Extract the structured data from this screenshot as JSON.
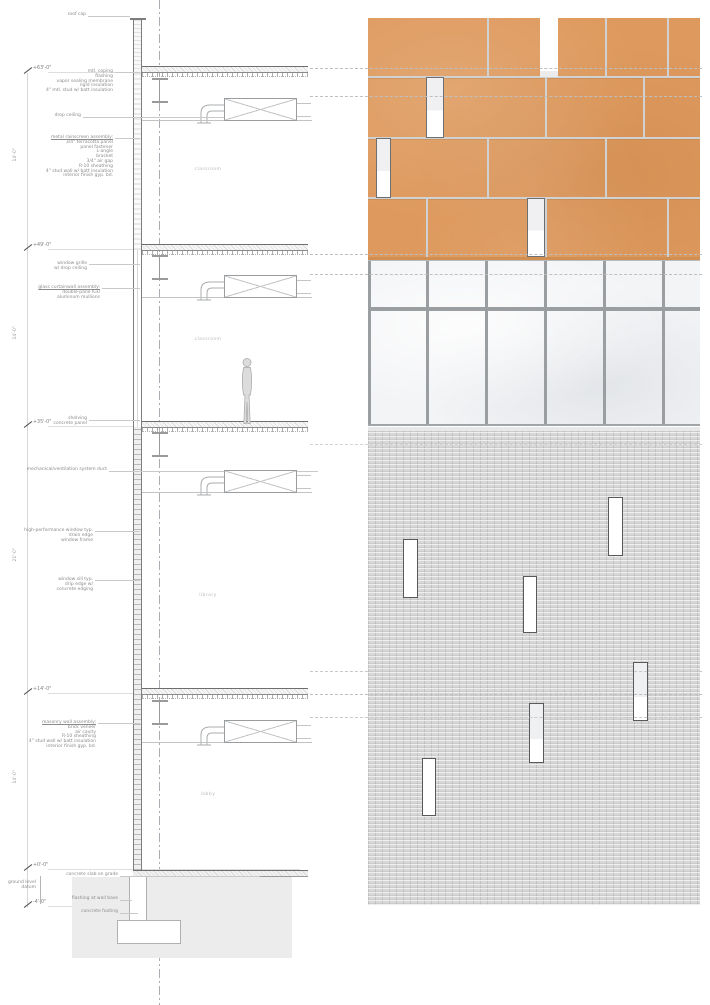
{
  "drawing": {
    "type": "architectural wall section with facade elevation",
    "levels": [
      {
        "label": "+63'-0\""
      },
      {
        "label": "+49'-0\""
      },
      {
        "label": "+35'-0\""
      },
      {
        "label": "+14'-0\""
      },
      {
        "label": "+0'-0\""
      },
      {
        "label": "-4'-0\""
      }
    ],
    "dimensions": [
      {
        "label": "14'-0\""
      },
      {
        "label": "14'-0\""
      },
      {
        "label": "21'-0\""
      },
      {
        "label": "14'-0\""
      }
    ],
    "rooms": [
      {
        "label": "classroom"
      },
      {
        "label": "classroom"
      },
      {
        "label": "library"
      },
      {
        "label": "lobby"
      }
    ],
    "callouts": {
      "roof_cap": {
        "lines": [
          "roof cap"
        ]
      },
      "parapet": {
        "lines": [
          "mtl. coping",
          "flashing",
          "vapor sealing membrane",
          "rigid insulation",
          "4\" mtl. stud w/ batt insulation"
        ]
      },
      "drop_ceiling": {
        "lines": [
          "drop ceiling"
        ]
      },
      "rainscreen": {
        "title": "metal rainscreen assembly:",
        "lines": [
          "3/4\" terracotta panel",
          "panel fastener",
          "L-angle",
          "bracket",
          "3/4\" air gap",
          "R-10 sheathing",
          "4\" stud wall w/ batt insulation",
          "interior finish gyp. bd."
        ]
      },
      "window_grille": {
        "lines": [
          "window grille",
          "w/ drop ceiling"
        ]
      },
      "curtainwall": {
        "title": "glass curtainwall assembly:",
        "lines": [
          "double-pane IGU",
          "aluminum mullions"
        ]
      },
      "shelving": {
        "lines": [
          "shelving",
          "concrete panel"
        ]
      },
      "mech_duct": {
        "lines": [
          "mechanical/ventilation system duct"
        ]
      },
      "window_head": {
        "lines": [
          "high-performance window typ.",
          "drain edge",
          "window frame"
        ]
      },
      "window_sill": {
        "lines": [
          "window sill typ.",
          "drip edge w/",
          "concrete edging"
        ]
      },
      "masonry": {
        "title": "masonry wall assembly:",
        "lines": [
          "brick veneer",
          "air cavity",
          "R-10 sheathing",
          "4\" stud wall w/ batt insulation",
          "interior finish gyp. bd."
        ]
      },
      "ground_datum": {
        "lines": [
          "ground level datum"
        ]
      },
      "slab_on_grade": {
        "lines": [
          "concrete slab on grade"
        ]
      },
      "wall_base": {
        "lines": [
          "flashing at wall base"
        ]
      },
      "footing": {
        "lines": [
          "concrete footing"
        ]
      }
    },
    "facade_summary": {
      "bands": [
        {
          "name": "terracotta rainscreen",
          "color": "#DE9A5E",
          "rows": 4,
          "narrow_windows": 3,
          "top_slot": 1
        },
        {
          "name": "glass curtainwall",
          "color": "#F3F4F6",
          "panes": 5,
          "transoms": 1,
          "mullion_color": "#9B9EA1"
        },
        {
          "name": "grey brick masonry",
          "color": "#D8D8D8",
          "narrow_windows": 6
        }
      ],
      "joint_color": "#CFD1D3",
      "window_frame_color": "#6D6F71"
    }
  }
}
